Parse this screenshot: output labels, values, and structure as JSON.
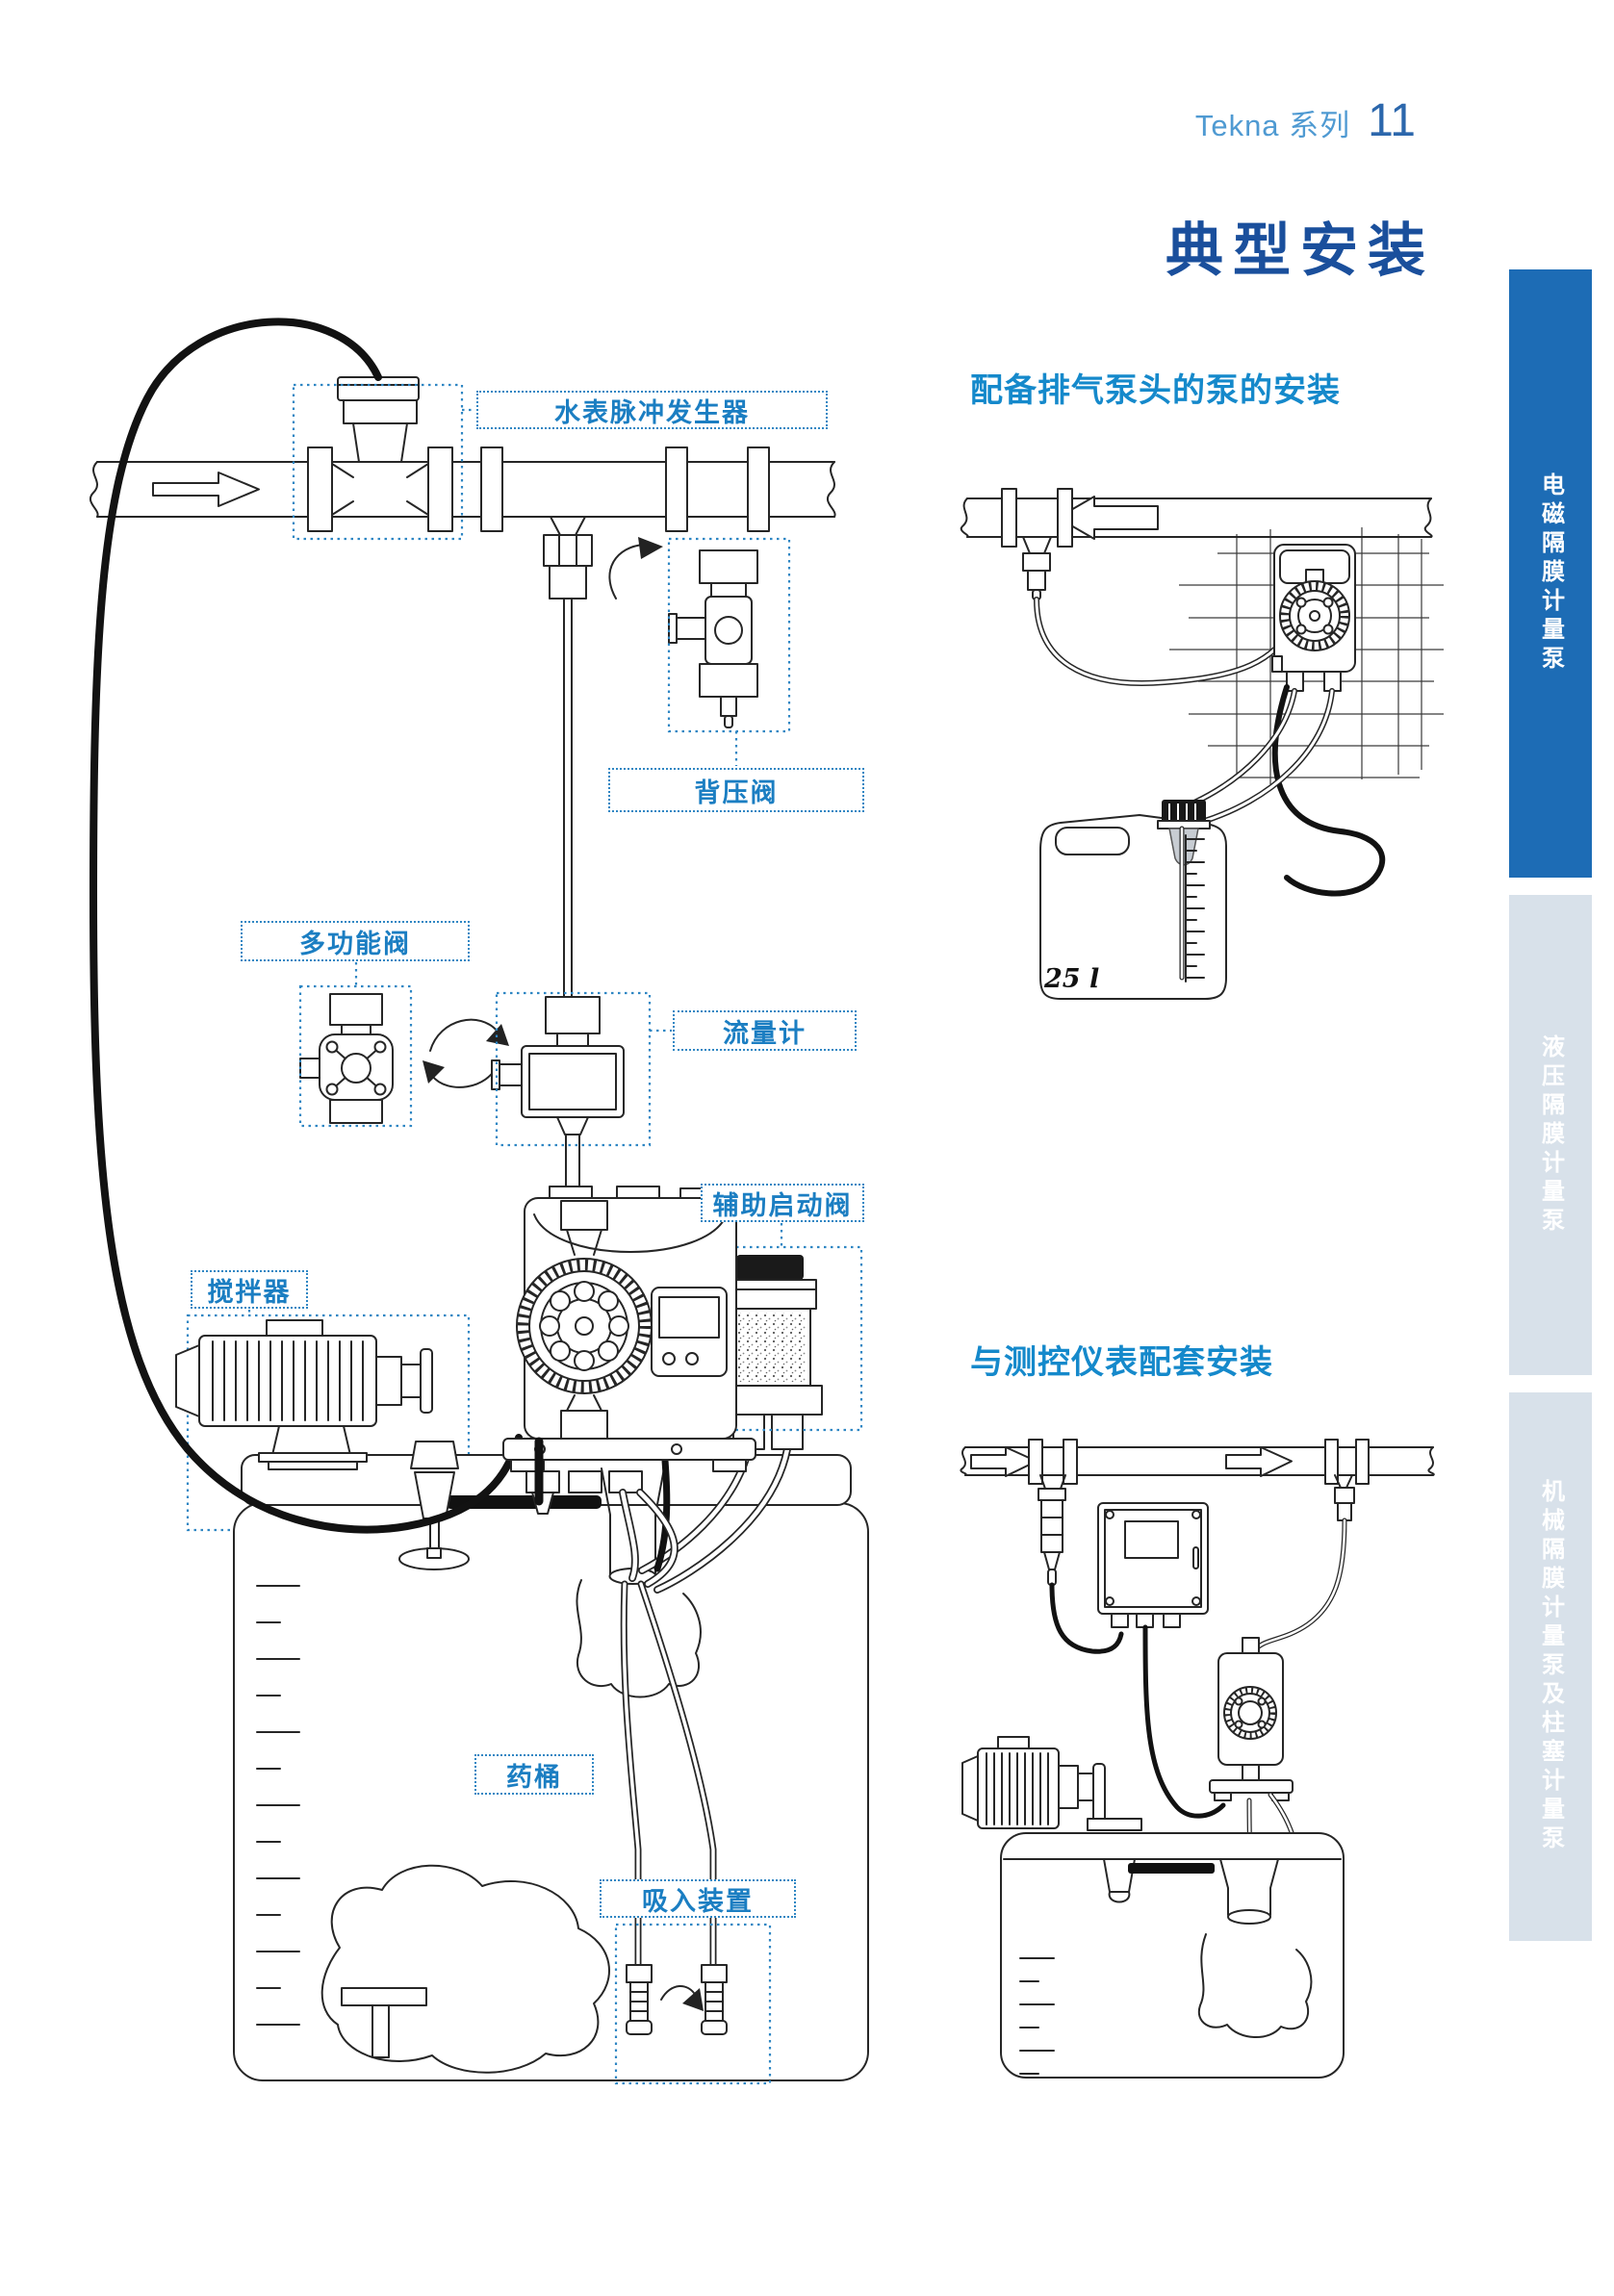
{
  "page": {
    "series": "Tekna 系列",
    "number": "11",
    "title": "典型安装"
  },
  "sidebar_tabs": [
    {
      "label": "电磁隔膜计量泵",
      "active": true
    },
    {
      "label": "液压隔膜计量泵",
      "active": false
    },
    {
      "label": "机械隔膜计量泵及柱塞计量泵",
      "active": false
    }
  ],
  "diagram_labels": {
    "water_meter": "水表脉冲发生器",
    "back_pressure_valve": "背压阀",
    "multifunction_valve": "多功能阀",
    "flow_meter": "流量计",
    "aux_priming_valve": "辅助启动阀",
    "agitator": "搅拌器",
    "chemical_tank": "药桶",
    "suction_device": "吸入装置"
  },
  "sections": {
    "degassing": {
      "heading": "配备排气泵头的泵的安装",
      "tank_volume": "25 l"
    },
    "instrument": {
      "heading": "与测控仪表配套安装"
    }
  },
  "colors": {
    "title_blue": "#1a4f9c",
    "heading_blue": "#1589cb",
    "label_blue": "#1b7ec2",
    "tab_active_bg": "#1d6cb5",
    "tab_inactive_bg": "#d8e1ea",
    "series_blue": "#4f9ad2",
    "page_number_blue": "#2c67ac"
  }
}
